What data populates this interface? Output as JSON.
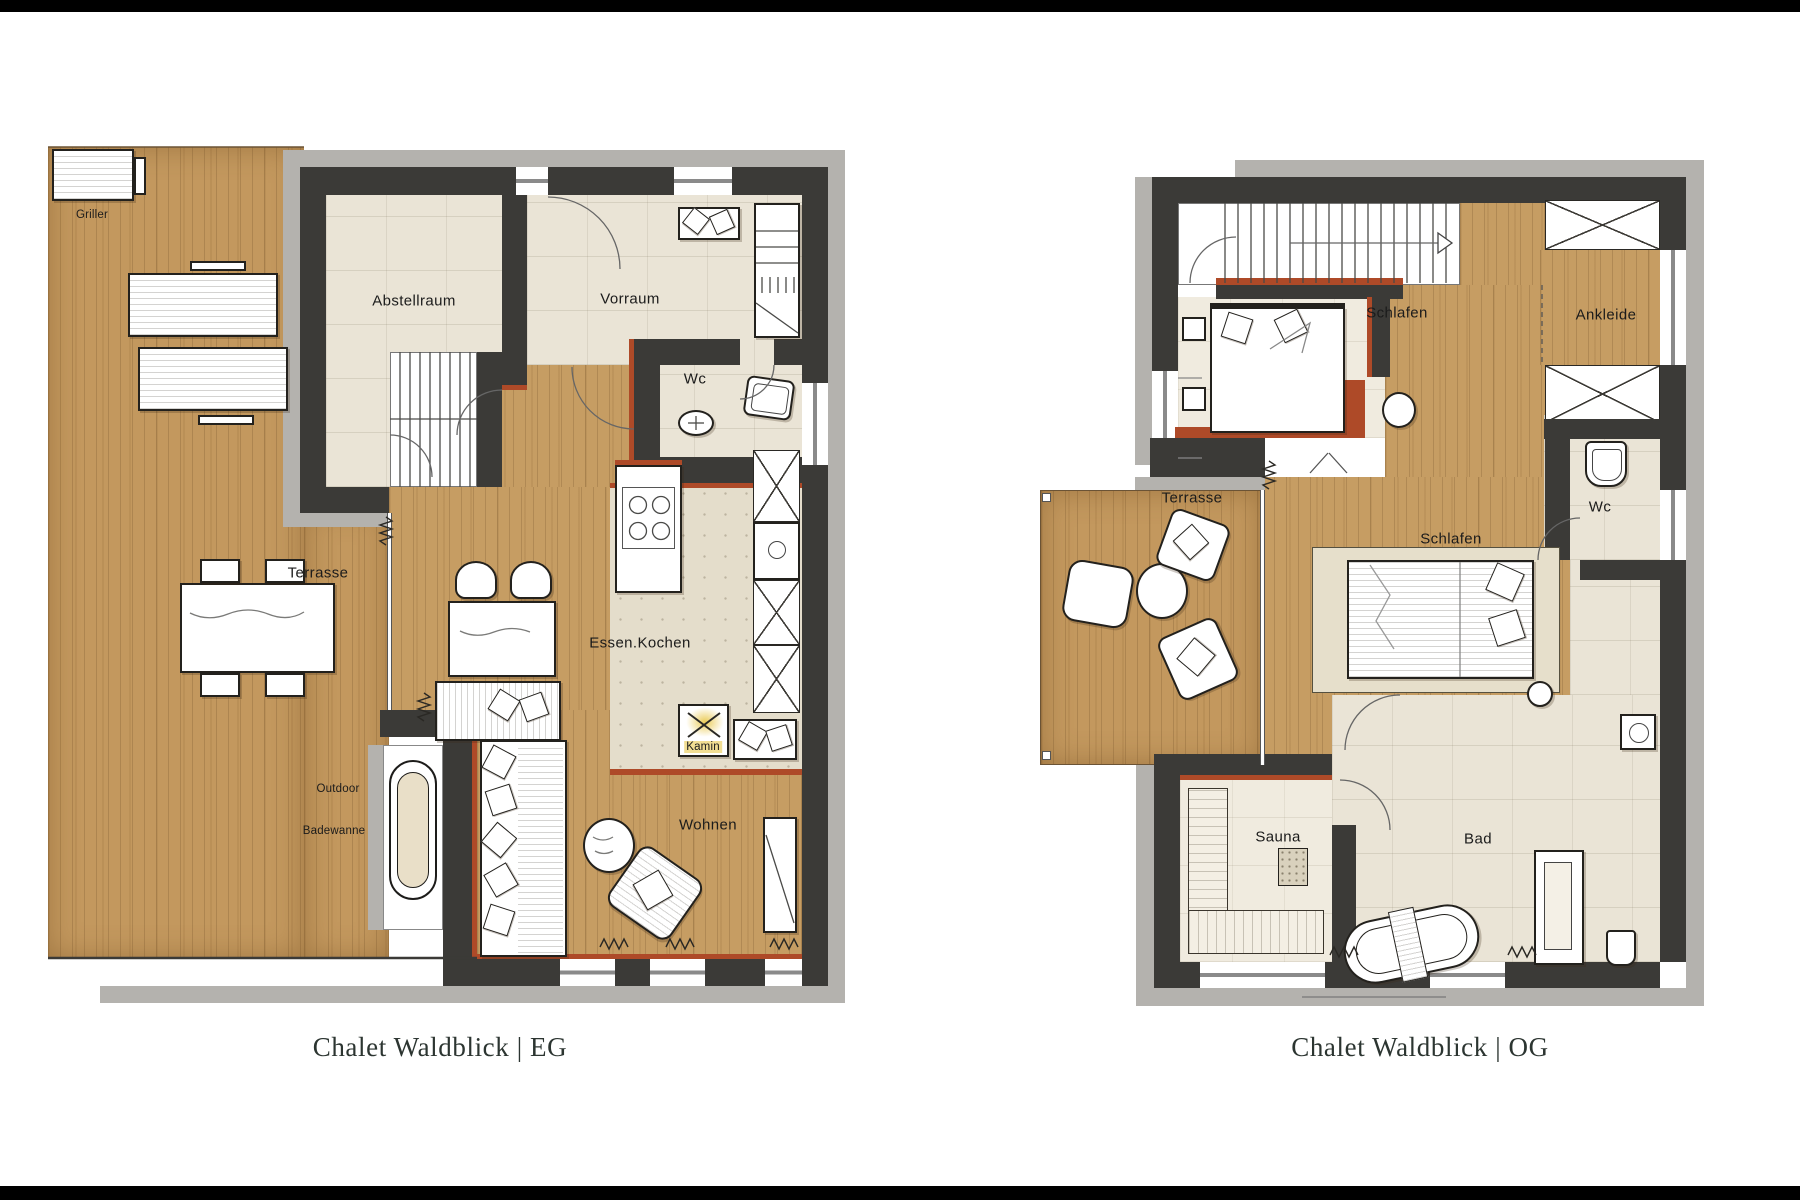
{
  "page": {
    "background": "#ffffff",
    "letterbox_color": "#000000"
  },
  "plans": {
    "eg": {
      "caption": "Chalet Waldblick | EG",
      "rooms": {
        "terrasse": "Terrasse",
        "abstellraum": "Abstellraum",
        "vorraum": "Vorraum",
        "wc": "Wc",
        "essen_kochen": "Essen.Kochen",
        "wohnen": "Wohnen"
      },
      "annotations": {
        "griller": "Griller",
        "kamin": "Kamin",
        "outdoor_line1": "Outdoor",
        "outdoor_line2": "Badewanne"
      }
    },
    "og": {
      "caption": "Chalet Waldblick | OG",
      "rooms": {
        "schlafen_1": "Schlafen",
        "schlafen_2": "Schlafen",
        "ankleide": "Ankleide",
        "wc": "Wc",
        "terrasse": "Terrasse",
        "sauna": "Sauna",
        "bad": "Bad"
      }
    }
  },
  "colors": {
    "wall": "#3b3a37",
    "outer_band": "#b4b2ae",
    "accent_rust": "#ae4a28",
    "wood": "#c69d63",
    "tile": "#eae4d6",
    "kitchen_tile": "#e4ddcb",
    "kamin_yellow": "#e7c33b",
    "label_text": "#1b1b1b",
    "caption_text": "#2c3531"
  }
}
